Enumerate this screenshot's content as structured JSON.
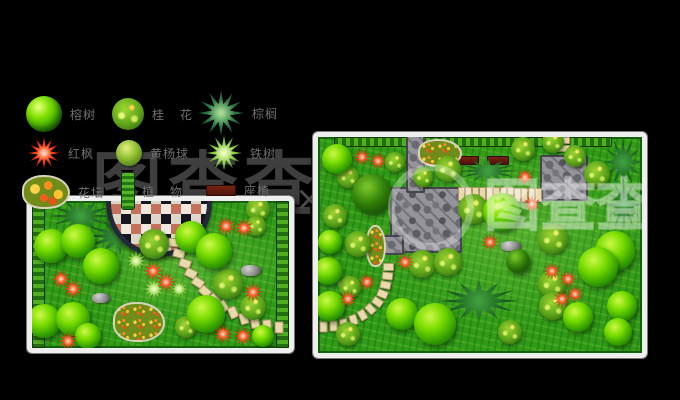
{
  "canvas": {
    "width": 680,
    "height": 400,
    "background": "#000000"
  },
  "watermark": {
    "text": "图查查",
    "mark": "×",
    "dark_color": "#3e3e3e",
    "overlay_color": "rgba(255,255,255,0.3)"
  },
  "legend": {
    "items": [
      {
        "icon": "glossy-tree-icon",
        "label": "榕树"
      },
      {
        "icon": "mottled-tree-icon",
        "label": "桂 花"
      },
      {
        "icon": "palm-icon",
        "label": "棕榈"
      },
      {
        "icon": "red-maple-icon",
        "label": "红枫"
      },
      {
        "icon": "shrub-ball-icon",
        "label": "黄杨球"
      },
      {
        "icon": "cycad-icon",
        "label": "铁树"
      },
      {
        "icon": "flowerbed-icon",
        "label": "花坛"
      },
      {
        "icon": "hedge-strip-icon",
        "label": "植 物"
      },
      {
        "icon": "bench-icon",
        "label": "座椅"
      }
    ]
  },
  "plans": {
    "left": {
      "frame_color": "#efefef",
      "lawn_color": "#2f9b17",
      "elements": [
        {
          "t": "hedge-v",
          "x": 0,
          "y": 0,
          "w": 13,
          "h": 147
        },
        {
          "t": "hedge-v",
          "x": 244,
          "y": 0,
          "w": 13,
          "h": 147
        },
        {
          "t": "bamboo",
          "x": 18,
          "y": -2,
          "w": 62,
          "h": 34
        },
        {
          "t": "bamboo",
          "x": 52,
          "y": 16,
          "w": 72,
          "h": 38
        },
        {
          "t": "bamboo",
          "x": 12,
          "y": 28,
          "w": 42,
          "h": 26
        },
        {
          "t": "mosaic",
          "x": 74,
          "y": -52,
          "w": 96,
          "h": 98
        },
        {
          "t": "stone",
          "x": 136,
          "y": 37,
          "w": 10,
          "h": 7,
          "r": 5
        },
        {
          "t": "stone",
          "x": 141,
          "y": 48,
          "w": 10,
          "h": 7,
          "r": 14
        },
        {
          "t": "stone",
          "x": 147,
          "y": 58,
          "w": 10,
          "h": 7,
          "r": 20
        },
        {
          "t": "stone",
          "x": 153,
          "y": 68,
          "w": 10,
          "h": 7,
          "r": 26
        },
        {
          "t": "stone",
          "x": 160,
          "y": 77,
          "w": 10,
          "h": 7,
          "r": 33
        },
        {
          "t": "stone",
          "x": 167,
          "y": 86,
          "w": 10,
          "h": 7,
          "r": 41
        },
        {
          "t": "stone",
          "x": 176,
          "y": 94,
          "w": 10,
          "h": 7,
          "r": 50
        },
        {
          "t": "stone",
          "x": 185,
          "y": 101,
          "w": 10,
          "h": 7,
          "r": 58
        },
        {
          "t": "stone",
          "x": 195,
          "y": 107,
          "w": 10,
          "h": 7,
          "r": 66
        },
        {
          "t": "stone",
          "x": 206,
          "y": 113,
          "w": 10,
          "h": 7,
          "r": 74
        },
        {
          "t": "stone",
          "x": 217,
          "y": 117,
          "w": 10,
          "h": 7,
          "r": 80
        },
        {
          "t": "stone",
          "x": 229,
          "y": 120,
          "w": 10,
          "h": 7,
          "r": 86
        },
        {
          "t": "stone",
          "x": 241,
          "y": 122,
          "w": 10,
          "h": 7,
          "r": 90
        },
        {
          "t": "rock",
          "x": 60,
          "y": 92,
          "w": 18,
          "h": 10
        },
        {
          "t": "rock",
          "x": 209,
          "y": 64,
          "w": 20,
          "h": 11
        },
        {
          "t": "flowerbed",
          "x": 81,
          "y": 101,
          "w": 48,
          "h": 36
        },
        {
          "t": "spiky",
          "x": 93,
          "y": 49,
          "w": 22,
          "h": 22
        },
        {
          "t": "spiky",
          "x": 110,
          "y": 76,
          "w": 24,
          "h": 24
        },
        {
          "t": "spiky",
          "x": 137,
          "y": 78,
          "w": 20,
          "h": 20
        },
        {
          "t": "shrub",
          "x": 107,
          "y": 28,
          "w": 30,
          "h": 30
        },
        {
          "t": "shrub",
          "x": 181,
          "y": 68,
          "w": 30,
          "h": 30
        },
        {
          "t": "shrub",
          "x": 208,
          "y": 93,
          "w": 26,
          "h": 26
        },
        {
          "t": "shrub",
          "x": 143,
          "y": 115,
          "w": 22,
          "h": 22
        },
        {
          "t": "shrub",
          "x": 214,
          "y": -4,
          "w": 24,
          "h": 24
        },
        {
          "t": "shrub",
          "x": 214,
          "y": 15,
          "w": 20,
          "h": 20
        },
        {
          "t": "tree",
          "x": 2,
          "y": 28,
          "w": 34,
          "h": 34
        },
        {
          "t": "tree",
          "x": 29,
          "y": 23,
          "w": 34,
          "h": 34
        },
        {
          "t": "tree",
          "x": 51,
          "y": 47,
          "w": 36,
          "h": 36
        },
        {
          "t": "tree",
          "x": 143,
          "y": 20,
          "w": 32,
          "h": 32
        },
        {
          "t": "tree",
          "x": 164,
          "y": 32,
          "w": 36,
          "h": 36
        },
        {
          "t": "tree",
          "x": 155,
          "y": 94,
          "w": 38,
          "h": 38
        },
        {
          "t": "tree",
          "x": -5,
          "y": 103,
          "w": 34,
          "h": 34
        },
        {
          "t": "tree",
          "x": 24,
          "y": 101,
          "w": 34,
          "h": 34
        },
        {
          "t": "tree",
          "x": 43,
          "y": 122,
          "w": 26,
          "h": 26
        },
        {
          "t": "tree",
          "x": 220,
          "y": 124,
          "w": 22,
          "h": 22
        },
        {
          "t": "red",
          "x": 19,
          "y": 68,
          "w": 20,
          "h": 20
        },
        {
          "t": "red",
          "x": 31,
          "y": 78,
          "w": 20,
          "h": 20
        },
        {
          "t": "red",
          "x": 111,
          "y": 60,
          "w": 20,
          "h": 20
        },
        {
          "t": "red",
          "x": 124,
          "y": 71,
          "w": 20,
          "h": 20
        },
        {
          "t": "red",
          "x": 184,
          "y": 15,
          "w": 20,
          "h": 20
        },
        {
          "t": "red",
          "x": 202,
          "y": 17,
          "w": 20,
          "h": 20
        },
        {
          "t": "red",
          "x": 211,
          "y": 81,
          "w": 20,
          "h": 20
        },
        {
          "t": "red",
          "x": 26,
          "y": 130,
          "w": 20,
          "h": 20
        },
        {
          "t": "red",
          "x": 181,
          "y": 123,
          "w": 20,
          "h": 20
        },
        {
          "t": "red",
          "x": 201,
          "y": 125,
          "w": 20,
          "h": 20
        }
      ]
    },
    "right": {
      "frame_color": "#efefef",
      "lawn_color": "#2f9b17",
      "elements": [
        {
          "t": "hedge-h",
          "x": 16,
          "y": 0,
          "w": 278,
          "h": 10
        },
        {
          "t": "bamboo",
          "x": 286,
          "y": 0,
          "w": 38,
          "h": 50
        },
        {
          "t": "bamboo",
          "x": 288,
          "y": 44,
          "w": 36,
          "h": 48
        },
        {
          "t": "patio",
          "x": 72,
          "y": 50,
          "w": 68,
          "h": 62
        },
        {
          "t": "patio",
          "x": 88,
          "y": -2,
          "w": 15,
          "h": 54
        },
        {
          "t": "patio",
          "x": 64,
          "y": 98,
          "w": 18,
          "h": 16
        },
        {
          "t": "patio",
          "x": 222,
          "y": 18,
          "w": 44,
          "h": 42
        },
        {
          "t": "stone",
          "x": 140,
          "y": 50,
          "w": 5,
          "h": 12,
          "r": 0
        },
        {
          "t": "stone",
          "x": 147,
          "y": 50,
          "w": 5,
          "h": 12,
          "r": 0
        },
        {
          "t": "stone",
          "x": 154,
          "y": 50,
          "w": 5,
          "h": 12,
          "r": 0
        },
        {
          "t": "stone",
          "x": 161,
          "y": 50,
          "w": 5,
          "h": 12,
          "r": 0
        },
        {
          "t": "stone",
          "x": 168,
          "y": 50,
          "w": 5,
          "h": 12,
          "r": 0
        },
        {
          "t": "stone",
          "x": 175,
          "y": 50,
          "w": 5,
          "h": 12,
          "r": 0
        },
        {
          "t": "stone",
          "x": 182,
          "y": 50,
          "w": 5,
          "h": 12,
          "r": 0
        },
        {
          "t": "stone",
          "x": 189,
          "y": 50,
          "w": 5,
          "h": 12,
          "r": 0
        },
        {
          "t": "stone",
          "x": 196,
          "y": 51,
          "w": 5,
          "h": 12,
          "r": 0
        },
        {
          "t": "stone",
          "x": 203,
          "y": 51,
          "w": 5,
          "h": 12,
          "r": 0
        },
        {
          "t": "stone",
          "x": 210,
          "y": 51,
          "w": 5,
          "h": 12,
          "r": 0
        },
        {
          "t": "stone",
          "x": 217,
          "y": 51,
          "w": 5,
          "h": 12,
          "r": 0
        },
        {
          "t": "stone",
          "x": 238,
          "y": 0,
          "w": 12,
          "h": 5,
          "r": 0
        },
        {
          "t": "stone",
          "x": 238,
          "y": 8,
          "w": 12,
          "h": 5,
          "r": 0
        },
        {
          "t": "stone",
          "x": 65,
          "y": 126,
          "w": 9,
          "h": 6,
          "r": 0
        },
        {
          "t": "stone",
          "x": 64,
          "y": 135,
          "w": 9,
          "h": 6,
          "r": 6
        },
        {
          "t": "stone",
          "x": 62,
          "y": 144,
          "w": 9,
          "h": 6,
          "r": 12
        },
        {
          "t": "stone",
          "x": 59,
          "y": 153,
          "w": 9,
          "h": 6,
          "r": 22
        },
        {
          "t": "stone",
          "x": 54,
          "y": 161,
          "w": 9,
          "h": 6,
          "r": 34
        },
        {
          "t": "stone",
          "x": 47,
          "y": 168,
          "w": 9,
          "h": 6,
          "r": 46
        },
        {
          "t": "stone",
          "x": 39,
          "y": 174,
          "w": 9,
          "h": 6,
          "r": 60
        },
        {
          "t": "stone",
          "x": 30,
          "y": 179,
          "w": 9,
          "h": 6,
          "r": 72
        },
        {
          "t": "stone",
          "x": 20,
          "y": 183,
          "w": 9,
          "h": 6,
          "r": 82
        },
        {
          "t": "stone",
          "x": 10,
          "y": 185,
          "w": 9,
          "h": 6,
          "r": 88
        },
        {
          "t": "stone",
          "x": 0,
          "y": 186,
          "w": 9,
          "h": 6,
          "r": 90
        },
        {
          "t": "bench",
          "x": 139,
          "y": 19,
          "w": 20,
          "h": 7
        },
        {
          "t": "bench",
          "x": 169,
          "y": 19,
          "w": 20,
          "h": 7
        },
        {
          "t": "flowerbed",
          "x": 100,
          "y": 2,
          "w": 40,
          "h": 24
        },
        {
          "t": "flowerbed",
          "x": 48,
          "y": 88,
          "w": 16,
          "h": 38
        },
        {
          "t": "bamboo",
          "x": 140,
          "y": 22,
          "w": 60,
          "h": 24
        },
        {
          "t": "bamboo",
          "x": 122,
          "y": 143,
          "w": 78,
          "h": 42
        },
        {
          "t": "rock",
          "x": 183,
          "y": 104,
          "w": 20,
          "h": 10
        },
        {
          "t": "rock",
          "x": 20,
          "y": 143,
          "w": 16,
          "h": 9
        },
        {
          "t": "shrub",
          "x": 19,
          "y": 29,
          "w": 22,
          "h": 22
        },
        {
          "t": "shrub",
          "x": 5,
          "y": 67,
          "w": 24,
          "h": 24
        },
        {
          "t": "shrub",
          "x": 27,
          "y": 94,
          "w": 26,
          "h": 26
        },
        {
          "t": "shrub",
          "x": 21,
          "y": 139,
          "w": 22,
          "h": 22
        },
        {
          "t": "shrub",
          "x": 18,
          "y": 185,
          "w": 24,
          "h": 24
        },
        {
          "t": "shrub",
          "x": 67,
          "y": 15,
          "w": 20,
          "h": 20
        },
        {
          "t": "shrub",
          "x": 117,
          "y": 19,
          "w": 26,
          "h": 26
        },
        {
          "t": "shrub",
          "x": 140,
          "y": 57,
          "w": 30,
          "h": 30
        },
        {
          "t": "shrub",
          "x": 90,
          "y": 113,
          "w": 28,
          "h": 28
        },
        {
          "t": "shrub",
          "x": 116,
          "y": 111,
          "w": 28,
          "h": 28
        },
        {
          "t": "shrub",
          "x": 224,
          "y": -6,
          "w": 22,
          "h": 22
        },
        {
          "t": "shrub",
          "x": 246,
          "y": 8,
          "w": 22,
          "h": 22
        },
        {
          "t": "shrub",
          "x": 266,
          "y": 24,
          "w": 26,
          "h": 26
        },
        {
          "t": "shrub",
          "x": 220,
          "y": 87,
          "w": 30,
          "h": 30
        },
        {
          "t": "shrub",
          "x": 220,
          "y": 133,
          "w": 28,
          "h": 28
        },
        {
          "t": "shrub",
          "x": 221,
          "y": 155,
          "w": 28,
          "h": 28
        },
        {
          "t": "shrub",
          "x": 180,
          "y": 183,
          "w": 24,
          "h": 24
        },
        {
          "t": "shrub",
          "x": 193,
          "y": 0,
          "w": 24,
          "h": 24
        },
        {
          "t": "shrub",
          "x": 95,
          "y": 30,
          "w": 20,
          "h": 20
        },
        {
          "t": "tree-dark",
          "x": 34,
          "y": 37,
          "w": 40,
          "h": 40
        },
        {
          "t": "tree-dark",
          "x": 188,
          "y": 112,
          "w": 24,
          "h": 24
        },
        {
          "t": "tree",
          "x": 4,
          "y": 7,
          "w": 30,
          "h": 30
        },
        {
          "t": "tree",
          "x": 165,
          "y": 56,
          "w": 38,
          "h": 38
        },
        {
          "t": "tree",
          "x": 277,
          "y": 94,
          "w": 40,
          "h": 40
        },
        {
          "t": "tree",
          "x": 260,
          "y": 110,
          "w": 40,
          "h": 40
        },
        {
          "t": "tree",
          "x": 68,
          "y": 161,
          "w": 32,
          "h": 32
        },
        {
          "t": "tree",
          "x": 96,
          "y": 166,
          "w": 42,
          "h": 42
        },
        {
          "t": "tree",
          "x": 245,
          "y": 165,
          "w": 30,
          "h": 30
        },
        {
          "t": "tree",
          "x": 289,
          "y": 154,
          "w": 30,
          "h": 30
        },
        {
          "t": "tree",
          "x": 286,
          "y": 181,
          "w": 28,
          "h": 28
        },
        {
          "t": "tree",
          "x": -4,
          "y": 120,
          "w": 28,
          "h": 28
        },
        {
          "t": "tree",
          "x": -3,
          "y": 154,
          "w": 30,
          "h": 30
        },
        {
          "t": "tree",
          "x": 0,
          "y": 93,
          "w": 24,
          "h": 24
        },
        {
          "t": "red",
          "x": 35,
          "y": 11,
          "w": 18,
          "h": 18
        },
        {
          "t": "red",
          "x": 51,
          "y": 15,
          "w": 18,
          "h": 18
        },
        {
          "t": "red",
          "x": 198,
          "y": 31,
          "w": 18,
          "h": 18
        },
        {
          "t": "red",
          "x": 205,
          "y": 58,
          "w": 18,
          "h": 18
        },
        {
          "t": "red",
          "x": 163,
          "y": 96,
          "w": 18,
          "h": 18
        },
        {
          "t": "red",
          "x": 78,
          "y": 116,
          "w": 18,
          "h": 18
        },
        {
          "t": "red",
          "x": 40,
          "y": 136,
          "w": 18,
          "h": 18
        },
        {
          "t": "red",
          "x": 21,
          "y": 153,
          "w": 18,
          "h": 18
        },
        {
          "t": "red",
          "x": 225,
          "y": 125,
          "w": 18,
          "h": 18
        },
        {
          "t": "red",
          "x": 241,
          "y": 133,
          "w": 18,
          "h": 18
        },
        {
          "t": "red",
          "x": 248,
          "y": 148,
          "w": 18,
          "h": 18
        },
        {
          "t": "red",
          "x": 235,
          "y": 153,
          "w": 18,
          "h": 18
        }
      ]
    }
  }
}
